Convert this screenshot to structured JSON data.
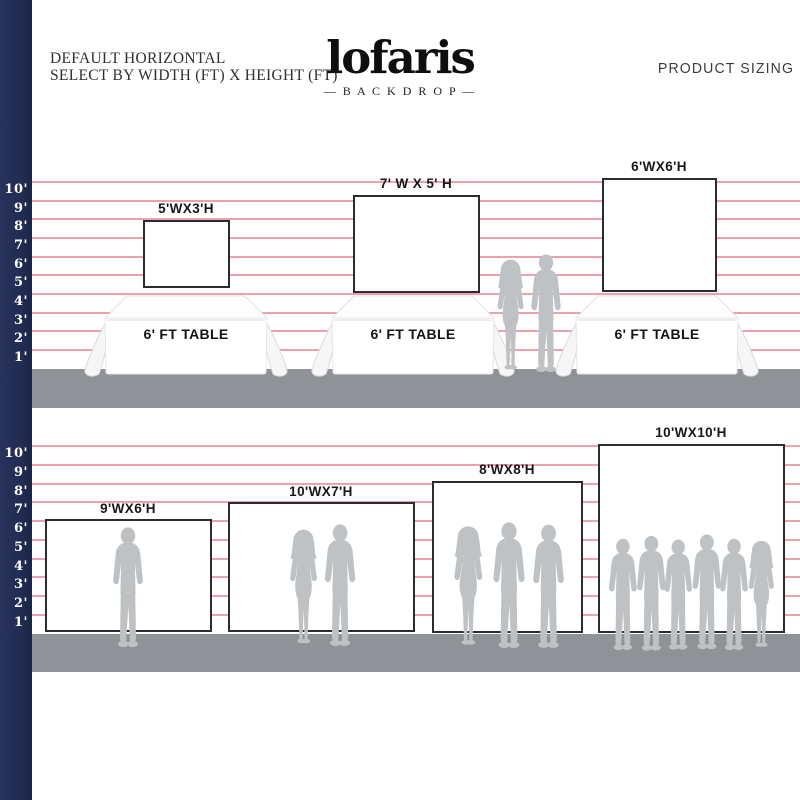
{
  "header": {
    "note_line1": "DEFAULT HORIZONTAL",
    "note_line2": "SELECT BY WIDTH (FT) X HEIGHT (FT)",
    "brand": "lofaris",
    "brand_tagline": "— B A C K D R O P —",
    "page_title": "PRODUCT SIZING"
  },
  "ruler_labels": [
    "10'",
    "9'",
    "8'",
    "7'",
    "6'",
    "5'",
    "4'",
    "3'",
    "2'",
    "1'"
  ],
  "ruler_unit": "ft",
  "sections": [
    {
      "name": "table-top backdrops",
      "table_label": "6' FT TABLE",
      "backdrops": [
        {
          "label": "5'WX3'H",
          "width_ft": 5,
          "height_ft": 3
        },
        {
          "label": "7' W X 5' H",
          "width_ft": 7,
          "height_ft": 5
        },
        {
          "label": "6'WX6'H",
          "width_ft": 6,
          "height_ft": 6
        }
      ]
    },
    {
      "name": "floor-standing backdrops",
      "backdrops": [
        {
          "label": "9'WX6'H",
          "width_ft": 9,
          "height_ft": 6
        },
        {
          "label": "10'WX7'H",
          "width_ft": 10,
          "height_ft": 7
        },
        {
          "label": "8'WX8'H",
          "width_ft": 8,
          "height_ft": 8
        },
        {
          "label": "10'WX10'H",
          "width_ft": 10,
          "height_ft": 10
        }
      ]
    }
  ],
  "colors": {
    "navy_bar": "#202c52",
    "scale_line_pink": "#efa0ae",
    "floor_gray": "#8f9296",
    "silhouette_gray": "#bfc2c5",
    "backdrop_border": "#2b2b30",
    "text": "#17171a"
  }
}
